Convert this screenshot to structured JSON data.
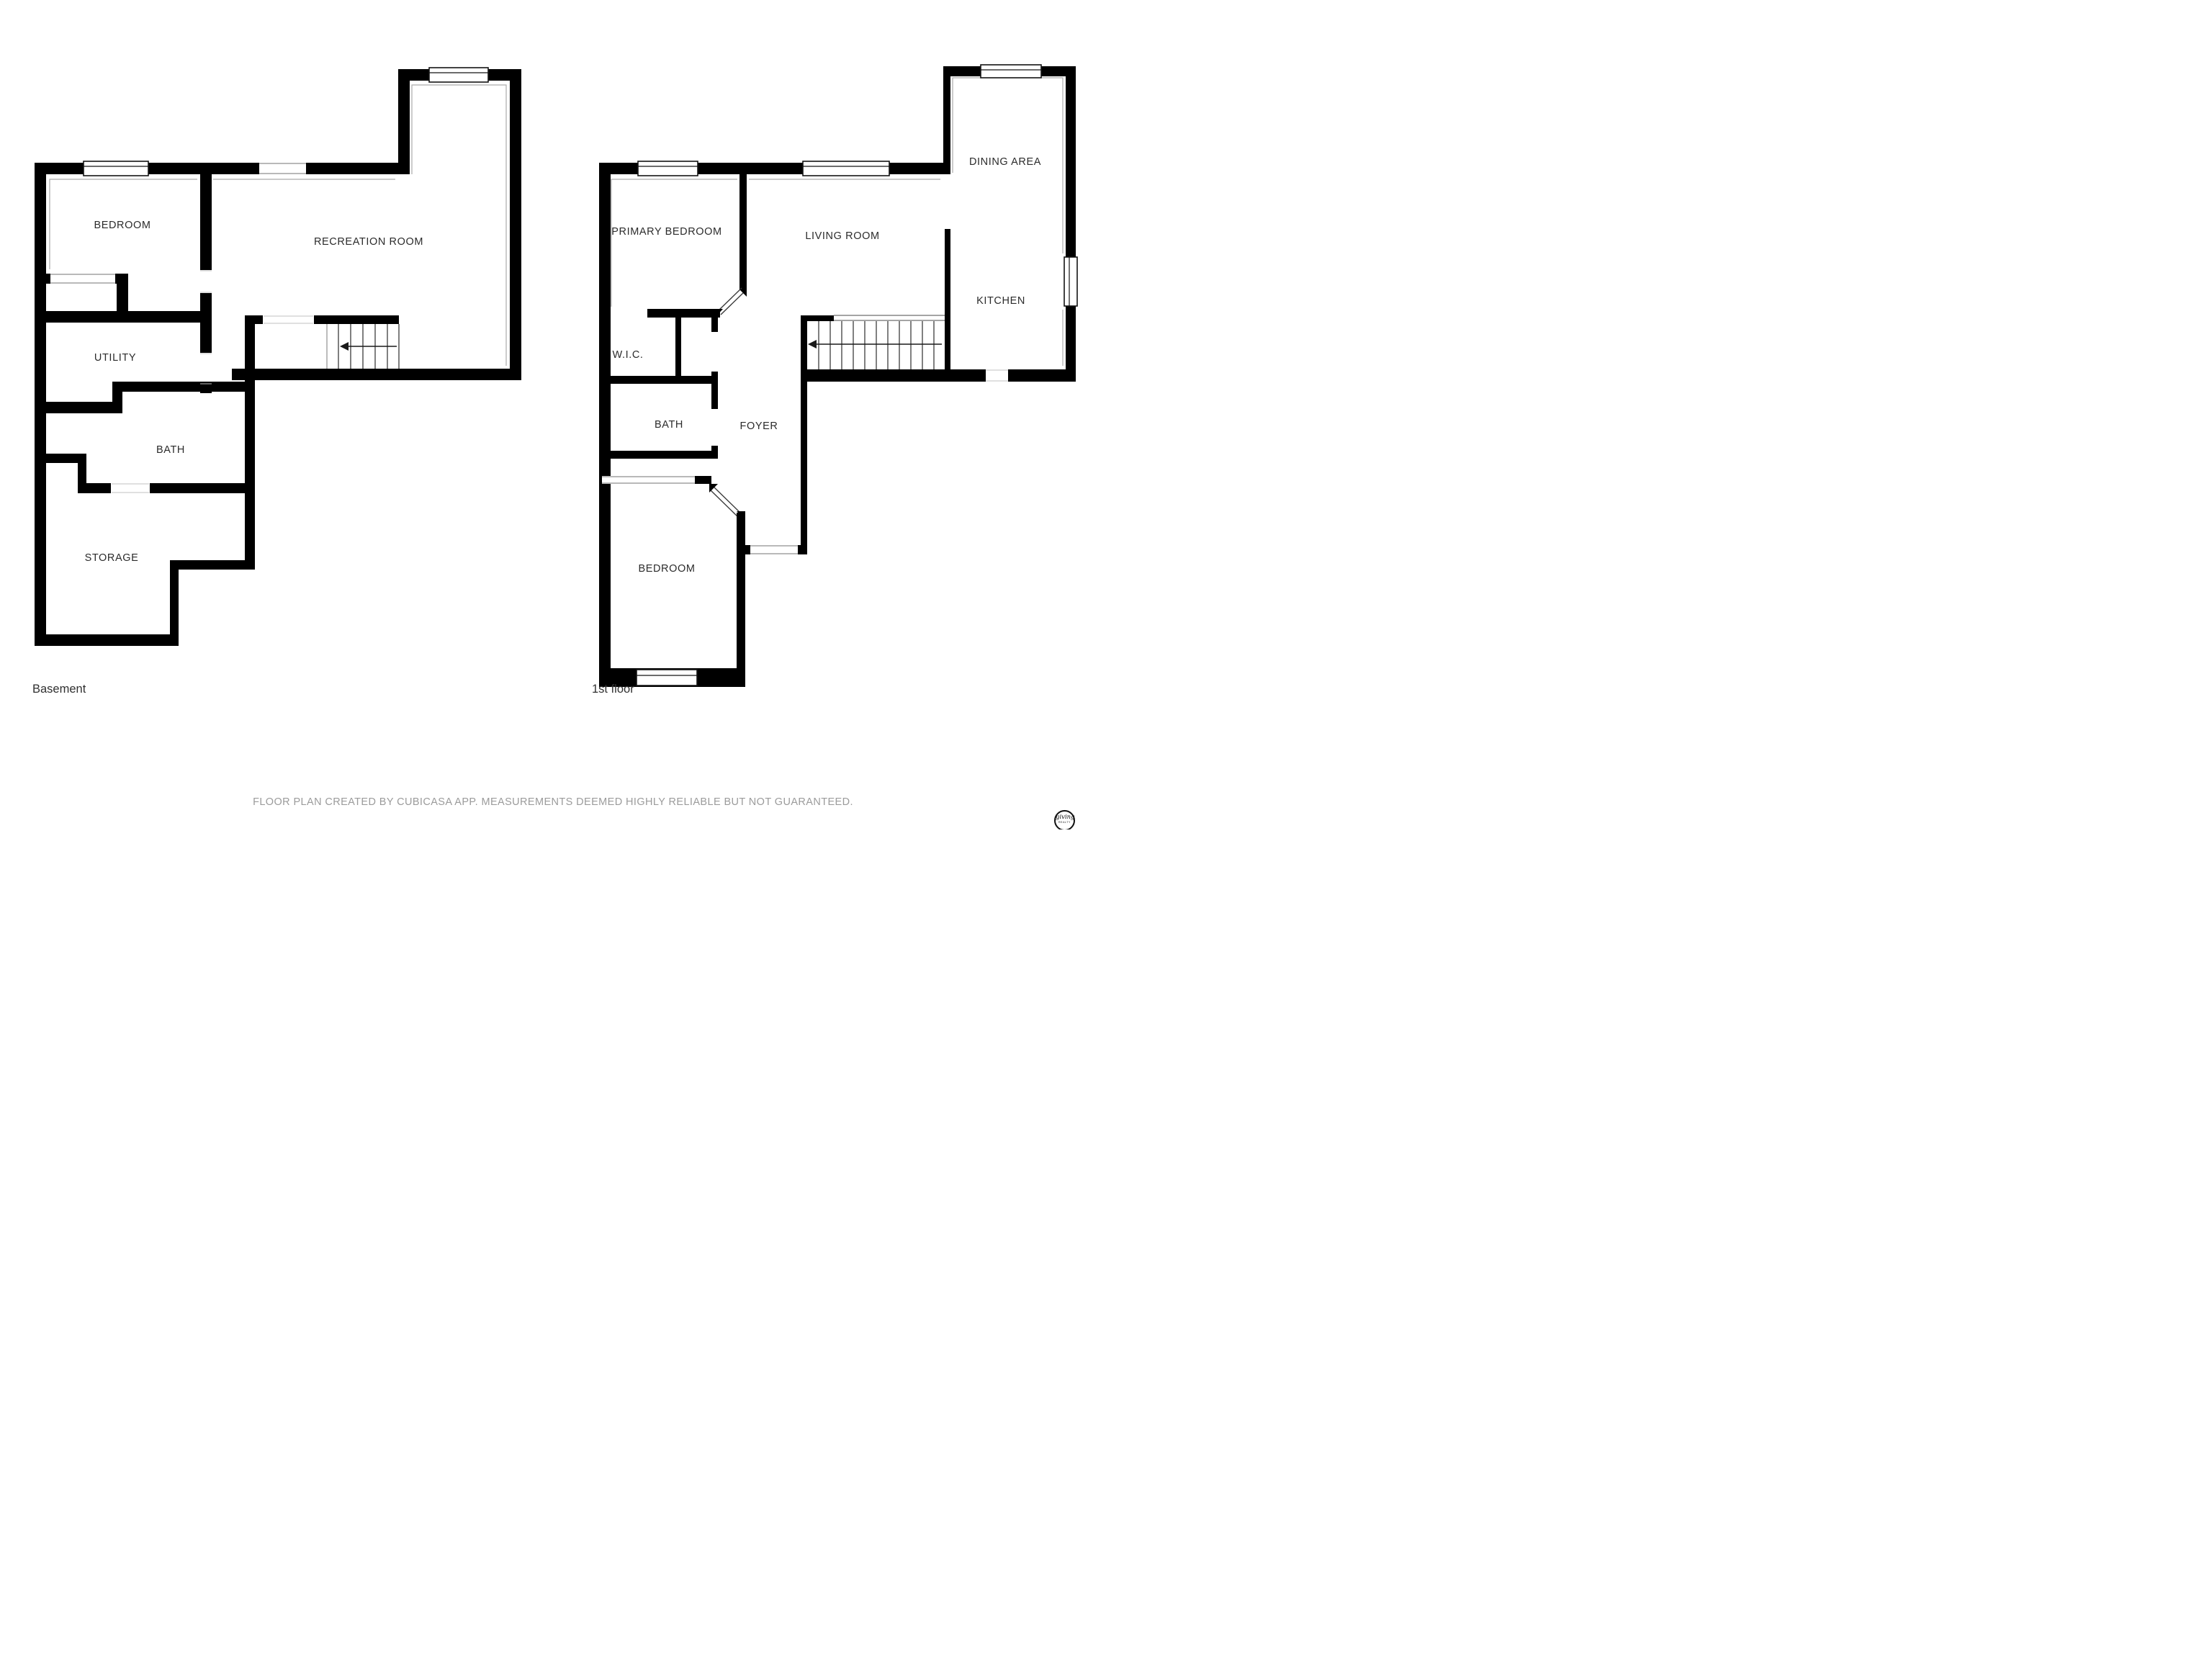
{
  "floors": [
    {
      "name": "Basement",
      "rooms": [
        {
          "label": "BEDROOM"
        },
        {
          "label": "RECREATION ROOM"
        },
        {
          "label": "UTILITY"
        },
        {
          "label": "BATH"
        },
        {
          "label": "STORAGE"
        }
      ]
    },
    {
      "name": "1st floor",
      "rooms": [
        {
          "label": "PRIMARY BEDROOM"
        },
        {
          "label": "LIVING ROOM"
        },
        {
          "label": "DINING AREA"
        },
        {
          "label": "KITCHEN"
        },
        {
          "label": "W.I.C."
        },
        {
          "label": "BATH"
        },
        {
          "label": "FOYER"
        },
        {
          "label": "BEDROOM"
        }
      ]
    }
  ],
  "footer": {
    "disclaimer": "FLOOR PLAN CREATED BY CUBICASA APP. MEASUREMENTS DEEMED HIGHLY RELIABLE BUT NOT GUARANTEED."
  },
  "logo": {
    "script_text": "giving",
    "subtext": "REALTY"
  },
  "colors": {
    "wall": "#000000",
    "label": "#2b2b2b",
    "footer_text": "#9b9b9b"
  }
}
